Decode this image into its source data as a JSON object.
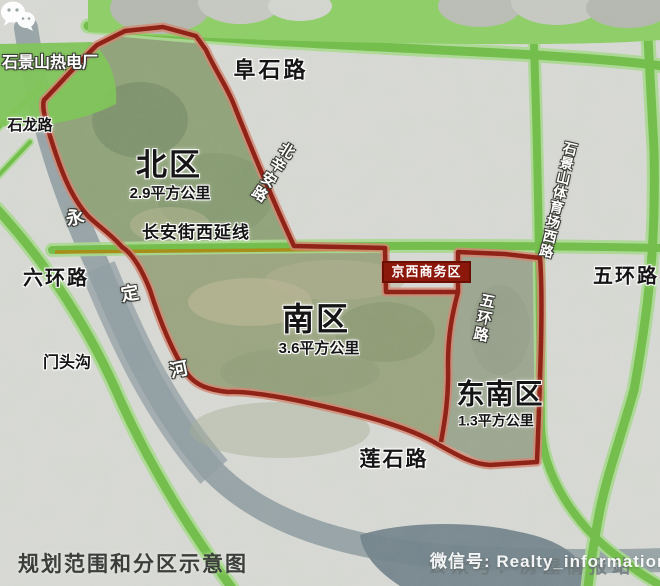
{
  "caption": "规划范围和分区示意图",
  "regions": [
    {
      "name": "北区",
      "area": "2.9平方公里"
    },
    {
      "name": "南区",
      "area": "3.6平方公里"
    },
    {
      "name": "东南区",
      "area": "1.3平方公里"
    }
  ],
  "districts": {
    "jingxi_cbd": "京西商务区"
  },
  "roads": {
    "fushi": "阜石路",
    "shilong": "石龙路",
    "beixinan": "北辛安路",
    "changan_west_ext": "长安街西延线",
    "sixth_ring": "六环路",
    "fifth_ring_east": "五环路",
    "fifth_ring_inner": "五环路",
    "stadium_west": "石景山体育场西路",
    "lianshi": "莲石路"
  },
  "landmarks": {
    "power_plant": "石景山热电厂",
    "mentougou": "门头沟",
    "river_chars": [
      "永",
      "定",
      "河"
    ]
  },
  "watermark": {
    "wechat_line": "微信号: Realty_information",
    "account_line": "公众号：房屋情报站"
  },
  "colors": {
    "boundary_red": "#8C170B",
    "road_green": "#6FBE45",
    "road_yellow": "#A8880A",
    "river_gray_blue": "#8D9BA1",
    "label_box_red": "#8C170B"
  }
}
